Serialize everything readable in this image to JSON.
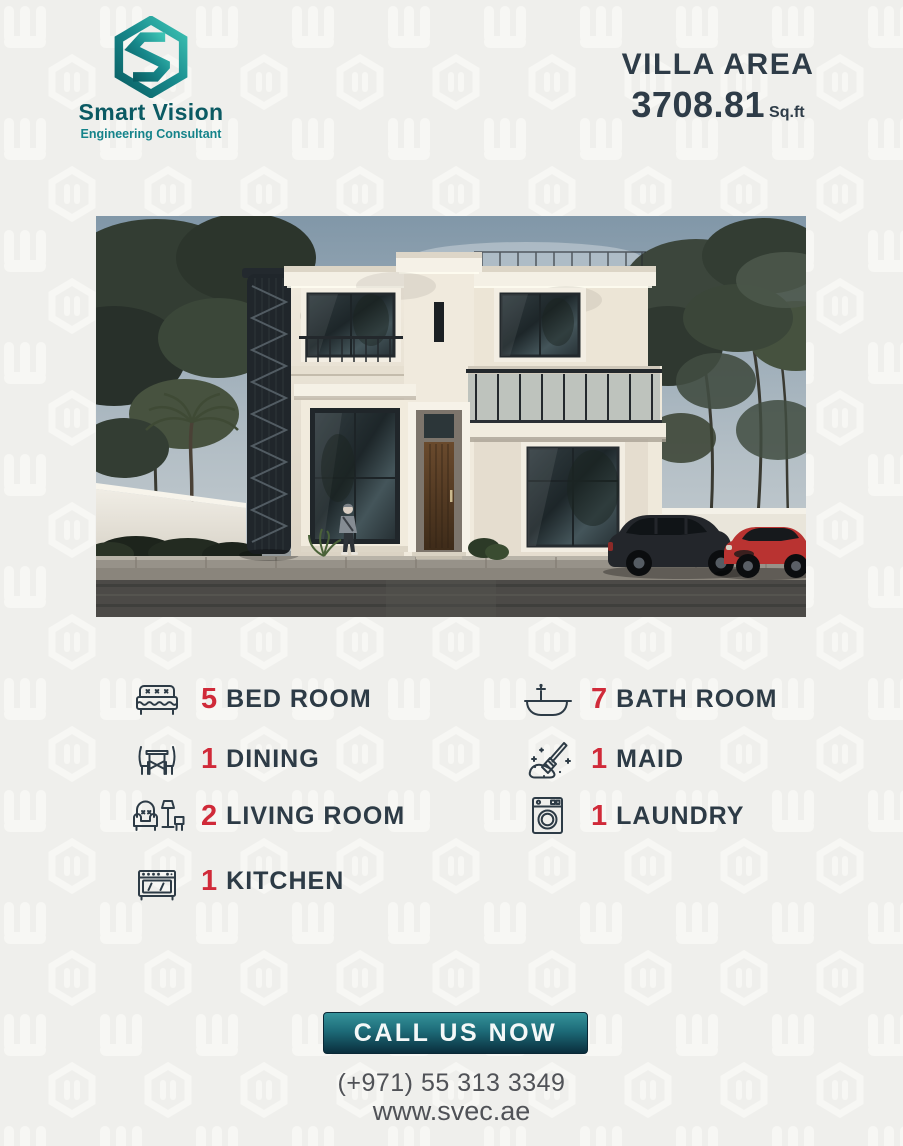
{
  "brand": {
    "name": "Smart Vision",
    "tagline": "Engineering Consultant"
  },
  "header": {
    "area_label": "VILLA AREA",
    "area_value": "3708.81",
    "area_unit": "Sq.ft"
  },
  "villa_image": {
    "description": "3D render of a two-storey modern classic villa with cream facade, large dark windows, glass balcony, black spiral staircase, boundary wall, trees, a person walking, a dark SUV and a red SUV parked in front"
  },
  "features": {
    "left": [
      {
        "icon": "bed-icon",
        "count": "5",
        "label": "BED ROOM"
      },
      {
        "icon": "dining-icon",
        "count": "1",
        "label": "DINING"
      },
      {
        "icon": "living-room-icon",
        "count": "2",
        "label": "LIVING ROOM"
      },
      {
        "icon": "kitchen-stove-icon",
        "count": "1",
        "label": "KITCHEN"
      }
    ],
    "right": [
      {
        "icon": "bathtub-icon",
        "count": "7",
        "label": "BATH ROOM"
      },
      {
        "icon": "maid-cleaning-icon",
        "count": "1",
        "label": "MAID"
      },
      {
        "icon": "washing-machine-icon",
        "count": "1",
        "label": "LAUNDRY"
      }
    ]
  },
  "cta": {
    "label": "CALL US NOW"
  },
  "contact": {
    "phone": "(+971) 55 313 3349",
    "website": "www.svec.ae"
  },
  "colors": {
    "accent_red": "#d02a39",
    "dark_text": "#2d3b46",
    "teal_dark": "#0b5a63",
    "teal": "#14838a",
    "button_top": "#35939b",
    "button_bottom": "#0a2e3d",
    "background": "#efefec",
    "gray_text": "#505257"
  }
}
